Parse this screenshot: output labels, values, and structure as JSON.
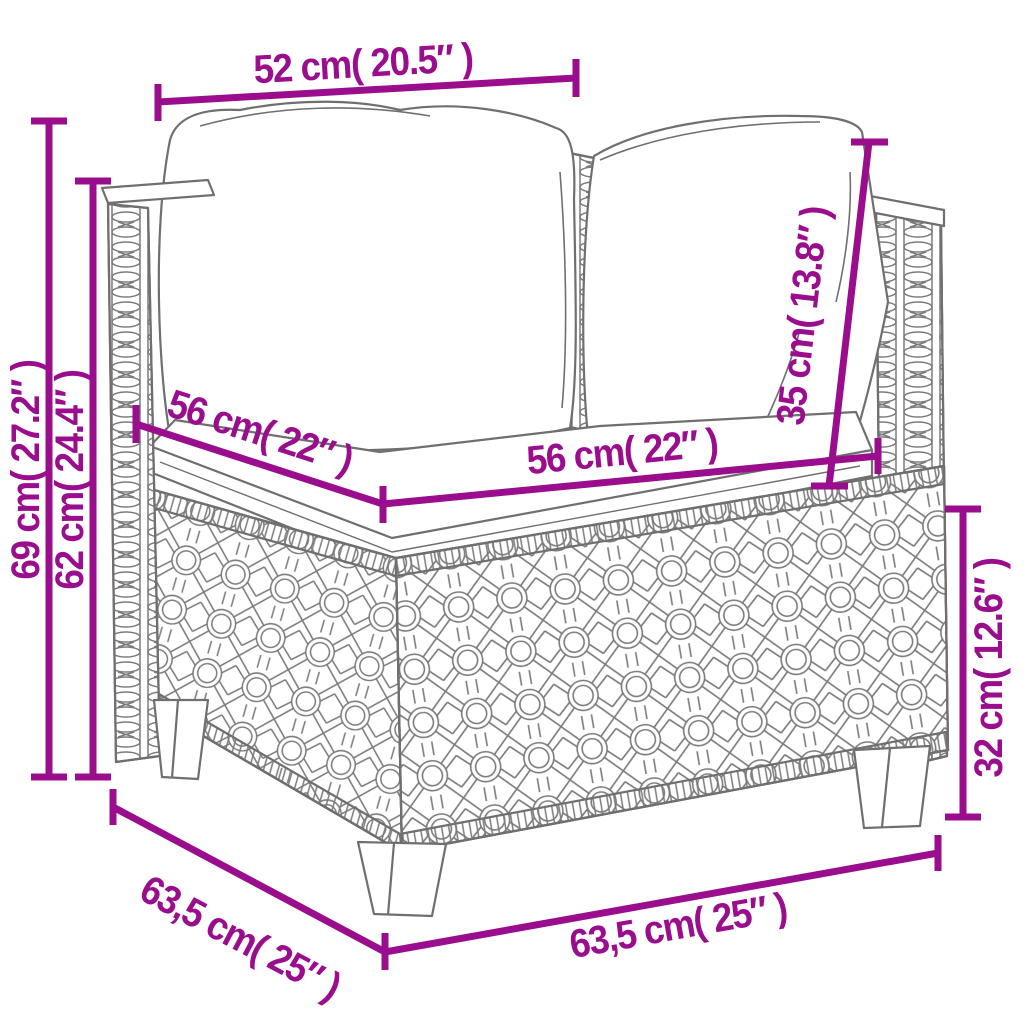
{
  "diagram": {
    "type": "product-dimension-diagram",
    "subject": "poly-rattan corner sofa section with back cushions and seat cushion",
    "accent_color": "#9a0d8c",
    "sketch_color": "#6f6f6f",
    "background_color": "#ffffff",
    "dimensions": {
      "top_width": "52 cm( 20.5″ )",
      "total_height": "69 cm( 27.2″ )",
      "arm_height": "62 cm( 24.4″ )",
      "seat_depth": "56 cm( 22″ )",
      "seat_width": "56 cm( 22″ )",
      "back_cushion_height": "35 cm( 13.8″ )",
      "base_height": "32 cm( 12.6″ )",
      "side_depth": "63,5 cm( 25″ )",
      "front_width": "63,5 cm( 25″ )"
    }
  }
}
